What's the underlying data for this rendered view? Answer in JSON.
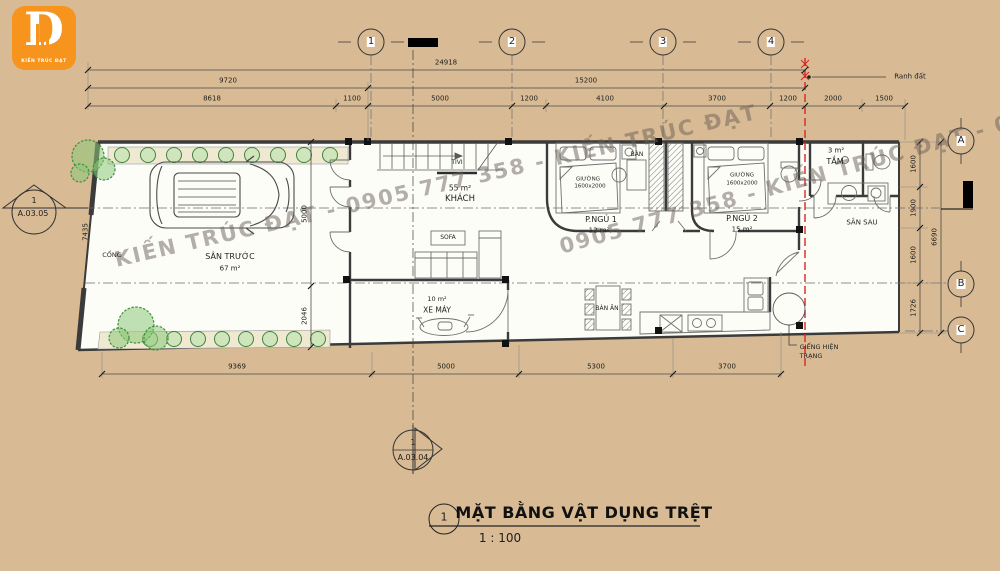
{
  "colors": {
    "background": "#d8bb94",
    "paper": "#fdfdf8",
    "accent_orange": "#f7941d",
    "boundary_red": "#d9251f",
    "plant_green": "#45813f"
  },
  "logo": {
    "letter": "D",
    "subtitle": "KIẾN TRÚC ĐẠT"
  },
  "watermark": {
    "line1": "KIẾN TRÚC ĐẠT - 0905 777 358 - KIẾN TRÚC ĐẠT",
    "line2": "0905 777 358 - KIẾN TRÚC ĐẠT - 0905 777 358"
  },
  "grid_bubbles": {
    "top": [
      "1",
      "2",
      "3",
      "4"
    ],
    "right": [
      "A",
      "B",
      "C"
    ]
  },
  "dimensions": {
    "top_total": "24918",
    "top_row2": [
      "9720",
      "15200"
    ],
    "top_row3": [
      "8618",
      "1100",
      "5000",
      "1200",
      "4100",
      "3700",
      "1200",
      "2000",
      "1500"
    ],
    "bottom_row": [
      "9369",
      "5000",
      "5300",
      "3700"
    ],
    "right_col": [
      "1600",
      "1900",
      "1600",
      "1726"
    ],
    "right_total": "6690",
    "left_edge": "7435",
    "yard_width": "5000",
    "yard_lower": "2046"
  },
  "annotations": {
    "ranh_dat": "Ranh đất",
    "gieng_line1": "GIẾNG HIỆN",
    "gieng_line2": "TRẠNG"
  },
  "rooms": {
    "cong": "CỔNG",
    "san_truoc": "SÂN TRƯỚC",
    "san_truoc_area": "67 m²",
    "tivi": "TIVI",
    "khach_area": "55 m²",
    "khach": "KHÁCH",
    "sofa": "SOFA",
    "p_ngu1": "P.NGỦ 1",
    "p_ngu1_area": "12 m²",
    "giuong": "GIƯỜNG",
    "giuong_size": "1600x2000",
    "ban": "BÀN",
    "p_ngu2": "P.NGỦ 2",
    "p_ngu2_area": "15 m²",
    "xe_may_area": "10 m²",
    "xe_may": "XE MÁY",
    "ban_an": "BÀN ĂN",
    "tam_area": "3 m²",
    "tam": "TẮM",
    "san_sau": "SÂN SAU"
  },
  "markers": {
    "left_num": "1",
    "left_code": "A.03.05",
    "bottom_num": "1",
    "bottom_code": "A.03.04"
  },
  "title_block": {
    "number": "1",
    "title": "MẶT BẰNG VẬT DỤNG TRỆT",
    "scale": "1 : 100"
  }
}
